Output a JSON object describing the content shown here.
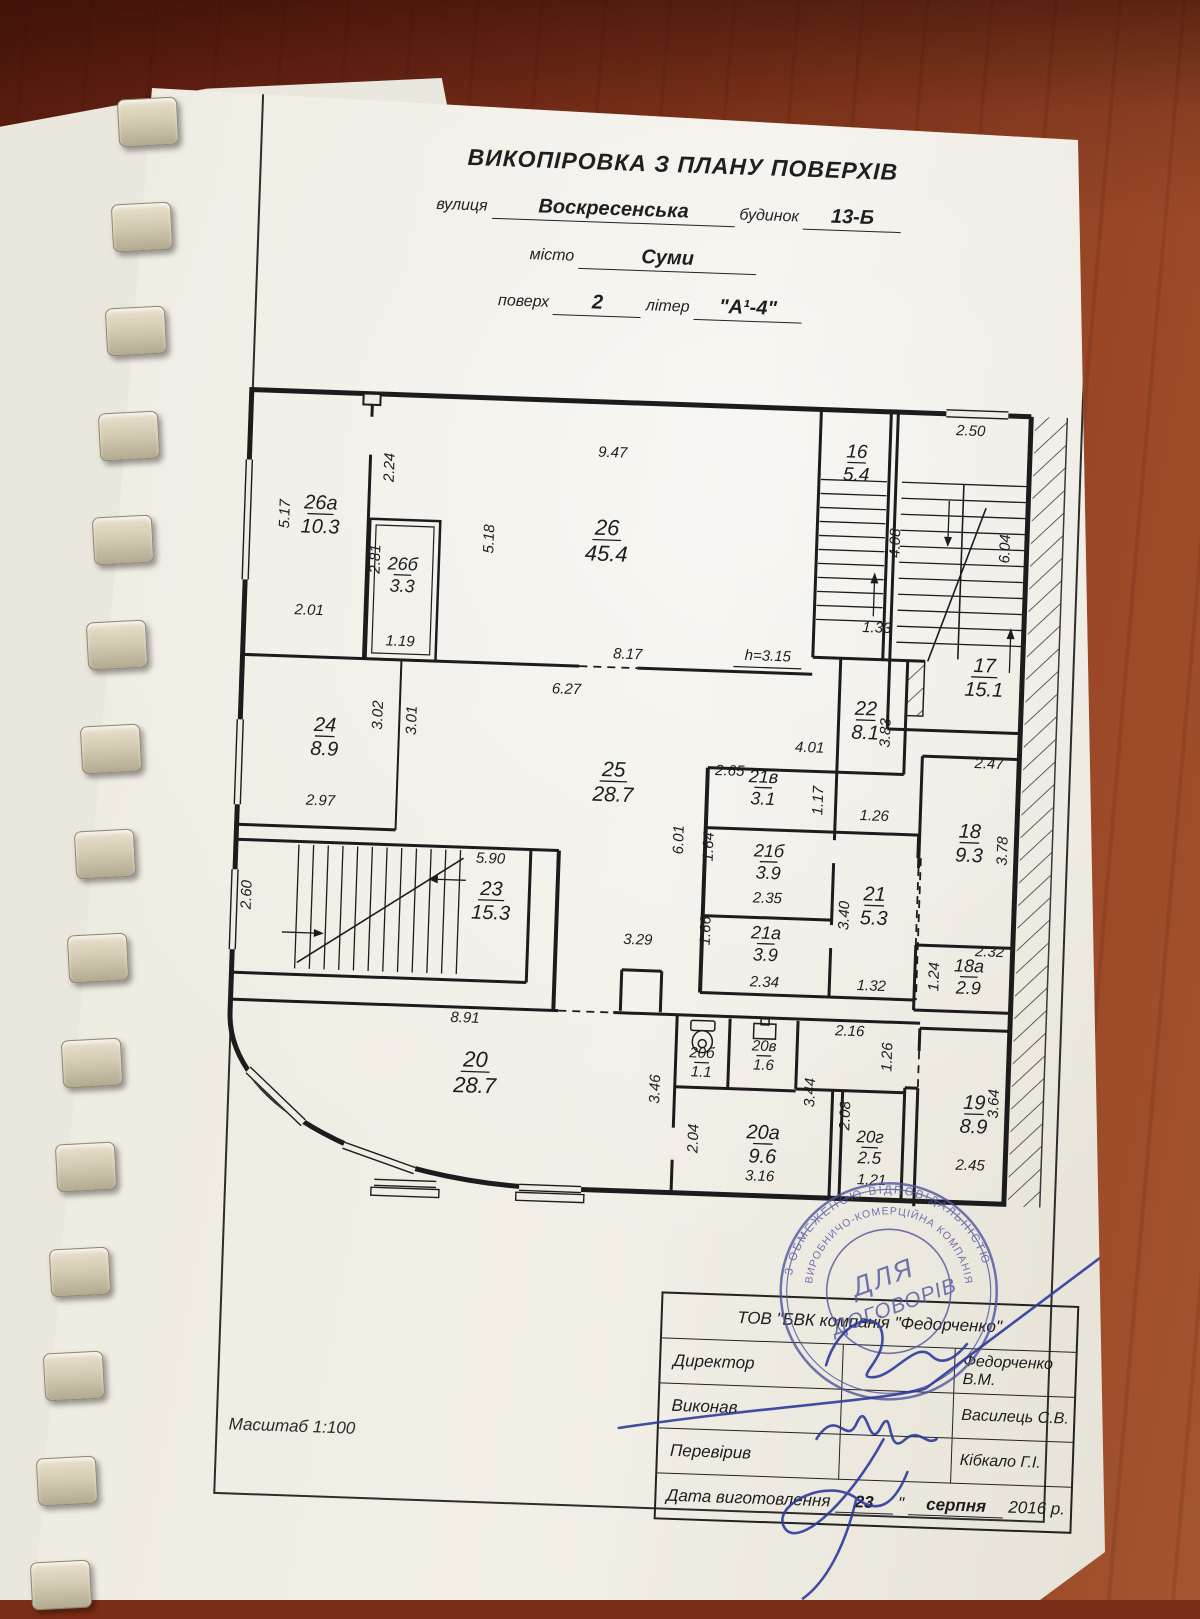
{
  "header": {
    "title": "ВИКОПІРОВКА З ПЛАНУ ПОВЕРХІВ",
    "street_label": "вулиця",
    "street_value": "Воскресенська",
    "building_label": "будинок",
    "building_value": "13-Б",
    "city_label": "місто",
    "city_value": "Суми",
    "floor_label": "поверх",
    "floor_value": "2",
    "letter_label": "літер",
    "letter_value": "\"А¹-4\""
  },
  "plan": {
    "rooms": [
      {
        "n": "26а",
        "a": "10.3",
        "x": 88,
        "y": 146,
        "fs": 20
      },
      {
        "n": "26б",
        "a": "3.3",
        "x": 172,
        "y": 204,
        "fs": 18
      },
      {
        "n": "26",
        "a": "45.4",
        "x": 375,
        "y": 162,
        "fs": 22
      },
      {
        "n": "16",
        "a": "5.4",
        "x": 622,
        "y": 76,
        "fs": 19
      },
      {
        "n": "17",
        "a": "15.1",
        "x": 757,
        "y": 286,
        "fs": 20
      },
      {
        "n": "22",
        "a": "8.1",
        "x": 640,
        "y": 333,
        "fs": 20
      },
      {
        "n": "24",
        "a": "8.9",
        "x": 100,
        "y": 368,
        "fs": 20
      },
      {
        "n": "25",
        "a": "28.7",
        "x": 390,
        "y": 403,
        "fs": 21
      },
      {
        "n": "21в",
        "a": "3.1",
        "x": 540,
        "y": 404,
        "fs": 18
      },
      {
        "n": "21б",
        "a": "3.9",
        "x": 548,
        "y": 478,
        "fs": 18
      },
      {
        "n": "21а",
        "a": "3.9",
        "x": 548,
        "y": 560,
        "fs": 18
      },
      {
        "n": "21",
        "a": "5.3",
        "x": 655,
        "y": 518,
        "fs": 20
      },
      {
        "n": "18",
        "a": "9.3",
        "x": 748,
        "y": 452,
        "fs": 20
      },
      {
        "n": "18а",
        "a": "2.9",
        "x": 752,
        "y": 586,
        "fs": 18
      },
      {
        "n": "23",
        "a": "15.3",
        "x": 272,
        "y": 526,
        "fs": 20
      },
      {
        "n": "20",
        "a": "28.7",
        "x": 262,
        "y": 698,
        "fs": 22
      },
      {
        "n": "20б",
        "a": "1.1",
        "x": 488,
        "y": 681,
        "fs": 15
      },
      {
        "n": "20в",
        "a": "1.6",
        "x": 550,
        "y": 672,
        "fs": 15
      },
      {
        "n": "20а",
        "a": "9.6",
        "x": 552,
        "y": 760,
        "fs": 20
      },
      {
        "n": "20г",
        "a": "2.5",
        "x": 659,
        "y": 760,
        "fs": 17
      },
      {
        "n": "19",
        "a": "8.9",
        "x": 762,
        "y": 723,
        "fs": 20
      }
    ],
    "dims": [
      {
        "t": "5.17",
        "x": 57,
        "y": 148,
        "r": -90
      },
      {
        "t": "2.24",
        "x": 160,
        "y": 98,
        "r": -90
      },
      {
        "t": "2.81",
        "x": 149,
        "y": 190,
        "r": -90
      },
      {
        "t": "9.47",
        "x": 378,
        "y": 80,
        "r": 0
      },
      {
        "t": "5.18",
        "x": 262,
        "y": 166,
        "r": -90
      },
      {
        "t": "2.01",
        "x": 80,
        "y": 248,
        "r": 0
      },
      {
        "t": "1.19",
        "x": 172,
        "y": 276,
        "r": 0
      },
      {
        "t": "8.17",
        "x": 400,
        "y": 281,
        "r": 0
      },
      {
        "t": "h=3.15",
        "x": 540,
        "y": 278,
        "r": 0,
        "u": 1
      },
      {
        "t": "2.50",
        "x": 735,
        "y": 46,
        "r": 0
      },
      {
        "t": "4.08",
        "x": 668,
        "y": 156,
        "r": -90
      },
      {
        "t": "6.04",
        "x": 778,
        "y": 158,
        "r": -90
      },
      {
        "t": "1.33",
        "x": 648,
        "y": 246,
        "r": 0
      },
      {
        "t": "3.02",
        "x": 157,
        "y": 346,
        "r": -90
      },
      {
        "t": "3.01",
        "x": 191,
        "y": 350,
        "r": -90
      },
      {
        "t": "2.97",
        "x": 98,
        "y": 438,
        "r": 0
      },
      {
        "t": "6.27",
        "x": 340,
        "y": 318,
        "r": 0
      },
      {
        "t": "4.01",
        "x": 585,
        "y": 368,
        "r": 0
      },
      {
        "t": "3.83",
        "x": 665,
        "y": 346,
        "r": -90
      },
      {
        "t": "2.65",
        "x": 506,
        "y": 394,
        "r": 0
      },
      {
        "t": "1.17",
        "x": 600,
        "y": 416,
        "r": -90
      },
      {
        "t": "1.26",
        "x": 652,
        "y": 434,
        "r": 0
      },
      {
        "t": "1.64",
        "x": 492,
        "y": 466,
        "r": -90
      },
      {
        "t": "2.35",
        "x": 548,
        "y": 520,
        "r": 0
      },
      {
        "t": "3.40",
        "x": 630,
        "y": 530,
        "r": -90
      },
      {
        "t": "1.66",
        "x": 492,
        "y": 550,
        "r": -90
      },
      {
        "t": "2.34",
        "x": 548,
        "y": 604,
        "r": 0
      },
      {
        "t": "1.32",
        "x": 655,
        "y": 604,
        "r": 0
      },
      {
        "t": "6.01",
        "x": 462,
        "y": 460,
        "r": -90
      },
      {
        "t": "3.29",
        "x": 420,
        "y": 566,
        "r": 0
      },
      {
        "t": "2.47",
        "x": 765,
        "y": 378,
        "r": 0
      },
      {
        "t": "3.78",
        "x": 786,
        "y": 460,
        "r": -90
      },
      {
        "t": "2.32",
        "x": 772,
        "y": 566,
        "r": 0
      },
      {
        "t": "1.24",
        "x": 722,
        "y": 588,
        "r": -90
      },
      {
        "t": "5.90",
        "x": 270,
        "y": 490,
        "r": 0
      },
      {
        "t": "2.60",
        "x": 32,
        "y": 530,
        "r": -90
      },
      {
        "t": "8.91",
        "x": 250,
        "y": 650,
        "r": 0
      },
      {
        "t": "3.46",
        "x": 447,
        "y": 710,
        "r": -90
      },
      {
        "t": "2.16",
        "x": 635,
        "y": 650,
        "r": 0
      },
      {
        "t": "1.26",
        "x": 678,
        "y": 670,
        "r": -90
      },
      {
        "t": "3.44",
        "x": 602,
        "y": 708,
        "r": -90
      },
      {
        "t": "2.04",
        "x": 487,
        "y": 758,
        "r": -90
      },
      {
        "t": "3.16",
        "x": 550,
        "y": 798,
        "r": 0
      },
      {
        "t": "2.08",
        "x": 638,
        "y": 730,
        "r": -90
      },
      {
        "t": "1.21",
        "x": 662,
        "y": 798,
        "r": 0
      },
      {
        "t": "3.64",
        "x": 786,
        "y": 713,
        "r": -90
      },
      {
        "t": "2.45",
        "x": 760,
        "y": 780,
        "r": 0
      }
    ]
  },
  "footer": {
    "scale": "Масштаб 1:100"
  },
  "titleblock": {
    "company": "ТОВ \"БВК компанія \"Федорченко\"",
    "rows": [
      {
        "label": "Директор",
        "name": "Федорченко  В.М."
      },
      {
        "label": "Виконав",
        "name": "Василець С.В."
      },
      {
        "label": "Перевірив",
        "name": "Кібкало Г.І."
      }
    ],
    "date_label": "Дата виготовлення",
    "date_day": "23",
    "date_quote": "\"",
    "date_month": "серпня",
    "date_year": "2016 р."
  },
  "stamp": {
    "ring_outer": "З ОБМЕЖЕНОЮ ВІДПОВІДАЛЬНІСТЮ",
    "ring_inner": "ВИРОБНИЧО-КОМЕРЦІЙНА КОМПАНІЯ",
    "center_line1": "ДЛЯ",
    "center_line2": "ДОГОВОРІВ",
    "color": "#4f55a0"
  }
}
